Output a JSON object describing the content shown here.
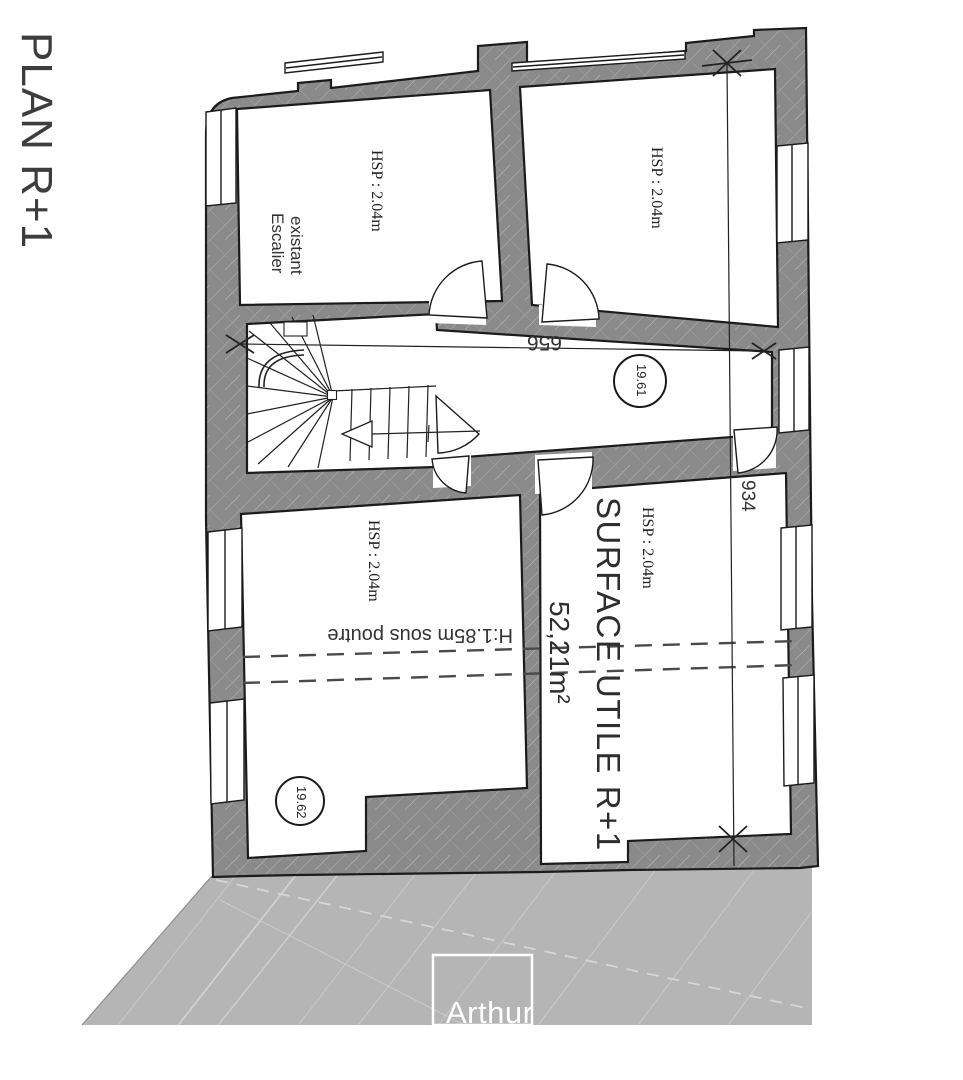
{
  "page": {
    "title": "PLAN R+1"
  },
  "rooms": {
    "top_left": {
      "ceiling_height": "HSP : 2.04m",
      "label_line1": "Escalier",
      "label_line2": "existant"
    },
    "top_right": {
      "ceiling_height": "HSP : 2.04m"
    },
    "corridor": {
      "area_tag": "19.61"
    },
    "bottom_left": {
      "ceiling_height": "HSP : 2.04m",
      "beam_note": "H:1.85m sous poutre",
      "area_tag": "19.62"
    },
    "bottom_right": {
      "ceiling_height": "HSP : 2.04m",
      "surface_title": "SURFACE UTILE R+1",
      "surface_value": "52,21m²"
    }
  },
  "dimensions": {
    "corridor_length": "656",
    "building_depth": "934"
  },
  "watermark": {
    "brand": "Arthur"
  },
  "colors": {
    "wall_fill": "#8a8a8a",
    "roof_fill": "#b5b5b5",
    "outline": "#1b1b1b",
    "watermark_text": "#ffffff"
  }
}
